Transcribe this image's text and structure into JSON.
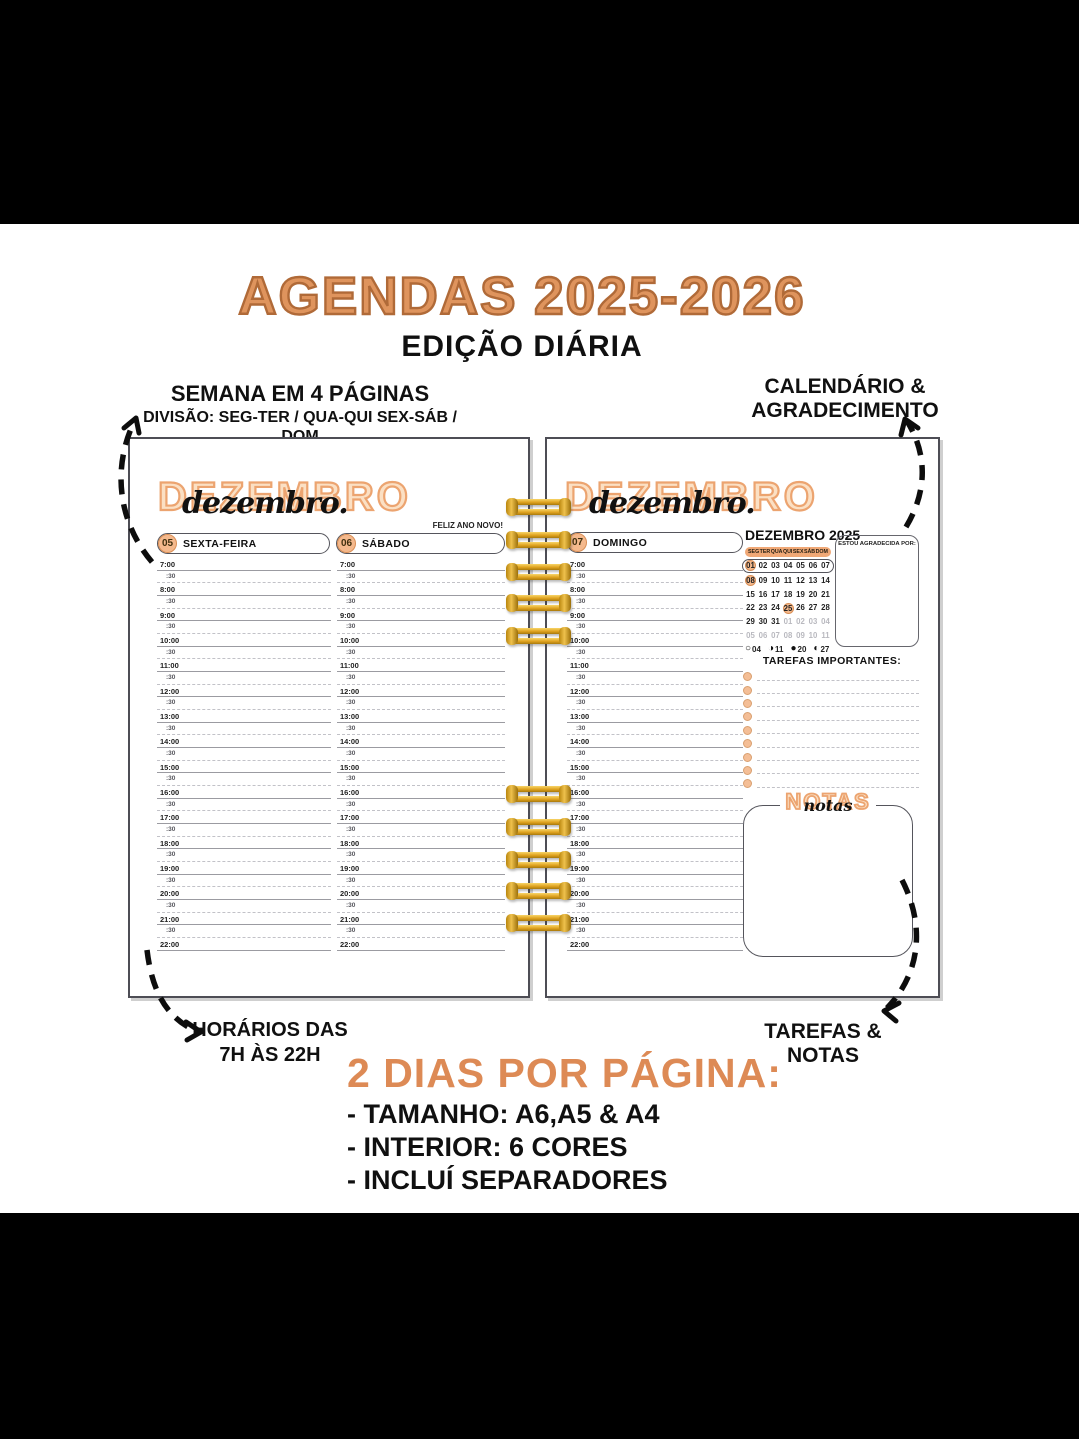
{
  "header": {
    "title": "AGENDAS 2025-2026",
    "subtitle": "EDIÇÃO DIÁRIA"
  },
  "annotations": {
    "top_left_line1": "SEMANA EM 4 PÁGINAS",
    "top_left_line2": "DIVISÃO: SEG-TER / QUA-QUI SEX-SÁB / DOM",
    "top_right_line1": "CALENDÁRIO &",
    "top_right_line2": "AGRADECIMENTO",
    "bottom_left_line1": "HORÁRIOS DAS",
    "bottom_left_line2": "7H ÀS 22H",
    "bottom_right": "TAREFAS & NOTAS"
  },
  "features": {
    "heading": "2 DIAS POR PÁGINA:",
    "items": [
      "- TAMANHO: A6,A5 & A4",
      "- INTERIOR: 6 CORES",
      "- INCLUÍ SEPARADORES"
    ]
  },
  "left_page": {
    "month_display": "DEZEMBRO",
    "month_script": "dezembro.",
    "holiday_note": "FELIZ ANO NOVO!",
    "days": [
      {
        "number": "05",
        "name": "SEXTA-FEIRA"
      },
      {
        "number": "06",
        "name": "SÁBADO"
      }
    ]
  },
  "right_page": {
    "month_display": "DEZEMBRO",
    "month_script": "dezembro.",
    "day": {
      "number": "07",
      "name": "DOMINGO"
    },
    "calendar": {
      "title": "DEZEMBRO 2025",
      "weekdays": [
        "SEG",
        "TER",
        "QUA",
        "QUI",
        "SEX",
        "SÁB",
        "DOM"
      ],
      "weeks": [
        {
          "outlined": true,
          "days": [
            {
              "d": "01",
              "c": "hl"
            },
            {
              "d": "02"
            },
            {
              "d": "03"
            },
            {
              "d": "04"
            },
            {
              "d": "05"
            },
            {
              "d": "06"
            },
            {
              "d": "07"
            }
          ]
        },
        {
          "days": [
            {
              "d": "08",
              "c": "hl"
            },
            {
              "d": "09"
            },
            {
              "d": "10"
            },
            {
              "d": "11"
            },
            {
              "d": "12"
            },
            {
              "d": "13"
            },
            {
              "d": "14"
            }
          ]
        },
        {
          "days": [
            {
              "d": "15"
            },
            {
              "d": "16"
            },
            {
              "d": "17"
            },
            {
              "d": "18"
            },
            {
              "d": "19"
            },
            {
              "d": "20"
            },
            {
              "d": "21"
            }
          ]
        },
        {
          "days": [
            {
              "d": "22"
            },
            {
              "d": "23"
            },
            {
              "d": "24"
            },
            {
              "d": "25",
              "c": "hl"
            },
            {
              "d": "26"
            },
            {
              "d": "27"
            },
            {
              "d": "28"
            }
          ]
        },
        {
          "days": [
            {
              "d": "29"
            },
            {
              "d": "30"
            },
            {
              "d": "31"
            },
            {
              "d": "01",
              "c": "muted"
            },
            {
              "d": "02",
              "c": "muted"
            },
            {
              "d": "03",
              "c": "muted"
            },
            {
              "d": "04",
              "c": "muted"
            }
          ]
        },
        {
          "days": [
            {
              "d": "05",
              "c": "muted"
            },
            {
              "d": "06",
              "c": "muted"
            },
            {
              "d": "07",
              "c": "muted"
            },
            {
              "d": "08",
              "c": "muted"
            },
            {
              "d": "09",
              "c": "muted"
            },
            {
              "d": "10",
              "c": "muted"
            },
            {
              "d": "11",
              "c": "muted"
            }
          ]
        }
      ],
      "moon_phases": [
        {
          "symbol": "○",
          "day": "04"
        },
        {
          "symbol": "◑",
          "day": "11"
        },
        {
          "symbol": "●",
          "day": "20"
        },
        {
          "symbol": "◐",
          "day": "27"
        }
      ]
    },
    "gratitude_label": "ESTOU AGRADECIDA POR:",
    "tasks_label": "TAREFAS IMPORTANTES:",
    "tasks_rows": 9,
    "notes_display": "NOTAS",
    "notes_script": "notas"
  },
  "schedule": {
    "hours": [
      "7:00",
      "8:00",
      "9:00",
      "10:00",
      "11:00",
      "12:00",
      "13:00",
      "14:00",
      "15:00",
      "16:00",
      "17:00",
      "18:00",
      "19:00",
      "20:00",
      "21:00",
      "22:00"
    ],
    "half_label": ":30"
  },
  "colors": {
    "accent_orange": "#DD8A55",
    "title_outline": "#B06A38",
    "peach_fill": "#F4B98D",
    "peach_outline": "#D98E55",
    "spiral_gold": "#DFA21F"
  }
}
